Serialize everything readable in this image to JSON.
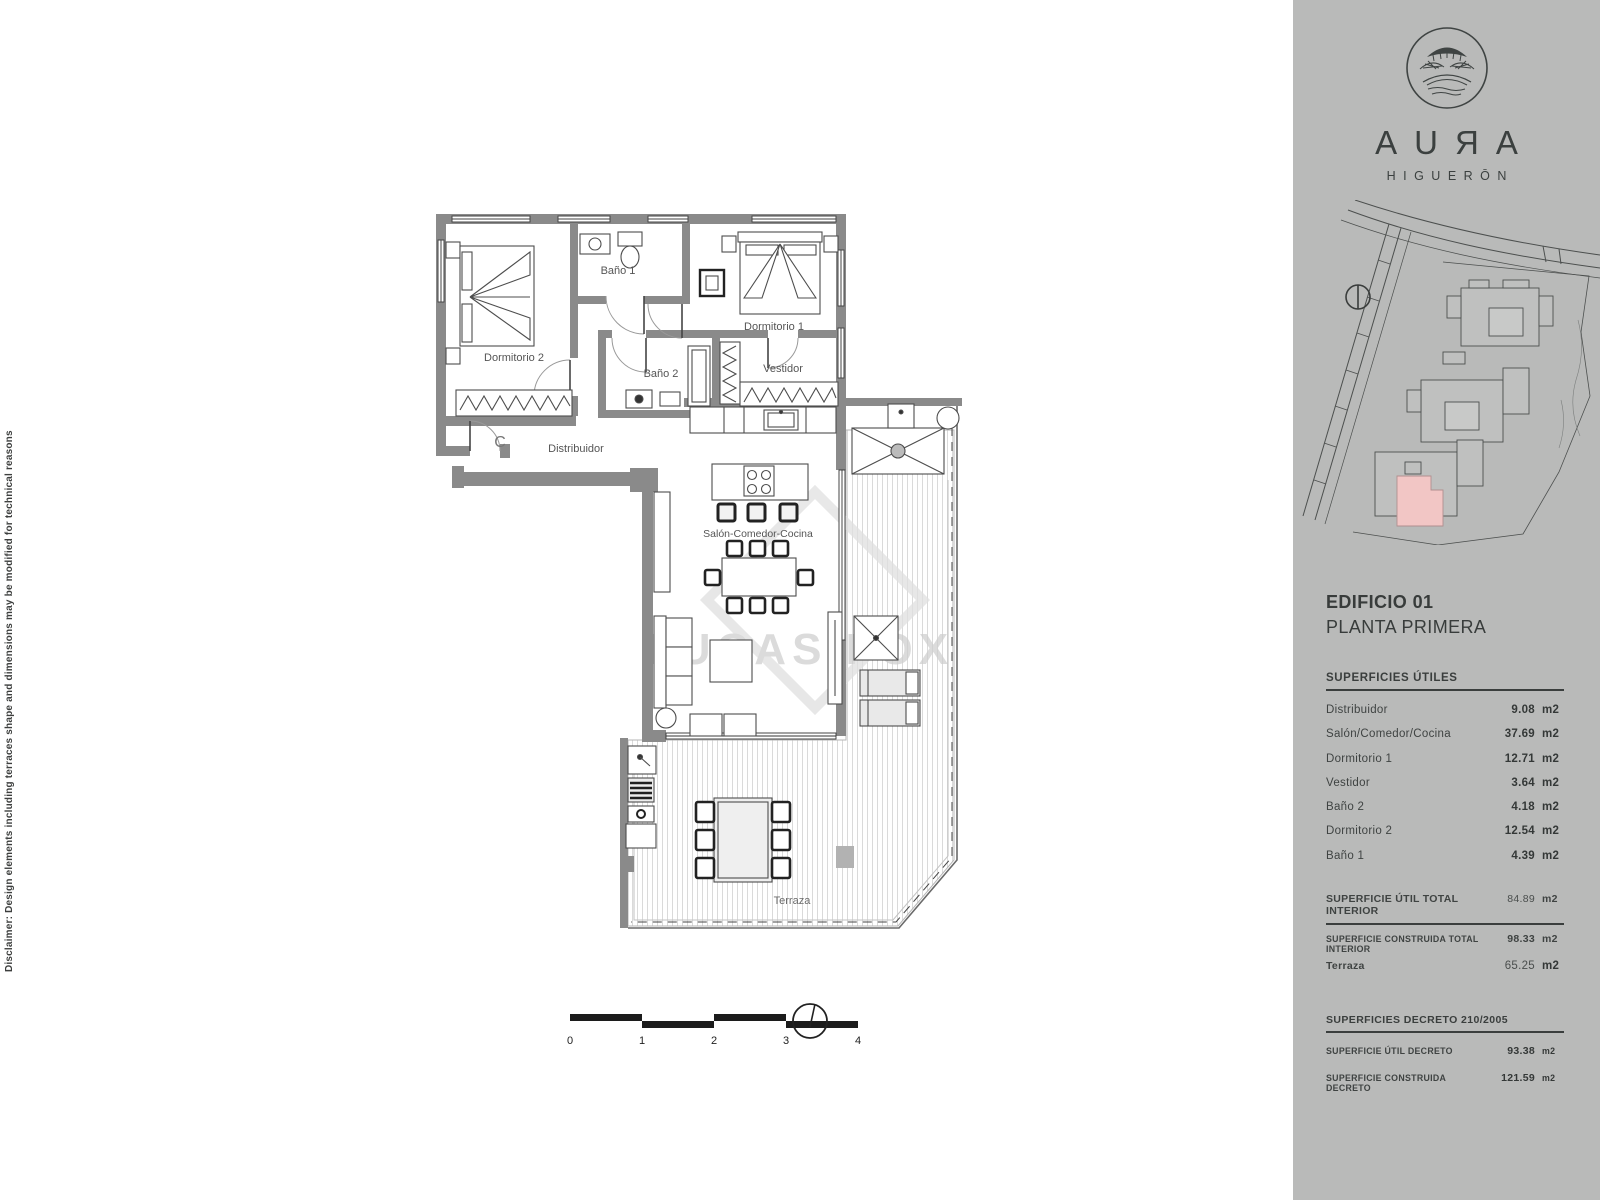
{
  "colors": {
    "sidebar_bg": "#b9bab9",
    "wall_gray": "#8a8a8a",
    "highlight_pink": "#f2c6c5",
    "ink": "#3b403f"
  },
  "disclaimer": "Disclaimer: Design elements including terraces shape and dimensions may be modified for technical reasons",
  "floorplan": {
    "rooms": [
      "Dormitorio 2",
      "Baño 1",
      "Dormitorio 1",
      "Vestidor",
      "Baño 2",
      "Distribuidor",
      "Salón-Comedor-Cocina",
      "Terraza"
    ],
    "entrance_label": "C",
    "watermark": "LUCAS FOX",
    "scale_ticks": [
      "0",
      "1",
      "2",
      "3",
      "4"
    ]
  },
  "sidebar": {
    "brand": {
      "letters": [
        "A",
        "U",
        "R",
        "A"
      ],
      "subtitle": "HIGUERŌN"
    },
    "title_line1": "EDIFICIO 01",
    "title_line2": "PLANTA PRIMERA",
    "surfaces": {
      "heading": "SUPERFICIES ÚTILES",
      "rows": [
        {
          "label": "Distribuidor",
          "value": "9.08",
          "unit": "m2"
        },
        {
          "label": "Salón/Comedor/Cocina",
          "value": "37.69",
          "unit": "m2"
        },
        {
          "label": "Dormitorio 1",
          "value": "12.71",
          "unit": "m2"
        },
        {
          "label": "Vestidor",
          "value": "3.64",
          "unit": "m2"
        },
        {
          "label": "Baño 2",
          "value": "4.18",
          "unit": "m2"
        },
        {
          "label": "Dormitorio 2",
          "value": "12.54",
          "unit": "m2"
        },
        {
          "label": "Baño 1",
          "value": "4.39",
          "unit": "m2"
        }
      ],
      "totals": [
        {
          "label": "SUPERFICIE ÚTIL TOTAL INTERIOR",
          "value": "84.89",
          "unit": "m2"
        },
        {
          "label": "SUPERFICIE CONSTRUIDA TOTAL INTERIOR",
          "value": "98.33",
          "unit": "m2"
        }
      ],
      "terraza_row": {
        "label": "Terraza",
        "value": "65.25",
        "unit": "m2"
      },
      "decreto": {
        "heading": "SUPERFICIES DECRETO 210/2005",
        "rows": [
          {
            "label": "SUPERFICIE ÚTIL DECRETO",
            "value": "93.38",
            "unit": "m2"
          },
          {
            "label": "SUPERFICIE CONSTRUIDA DECRETO",
            "value": "121.59",
            "unit": "m2"
          }
        ]
      }
    }
  }
}
